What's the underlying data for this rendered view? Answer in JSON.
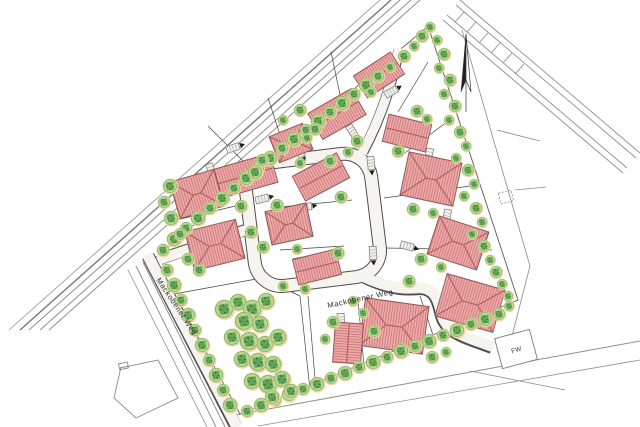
{
  "map": {
    "street_labels": [
      {
        "id": "street-left",
        "text": "Mackobener Weg"
      },
      {
        "id": "street-center",
        "text": "Mackobener Weg"
      }
    ],
    "markers": {
      "fw_label": "FW",
      "north_arrow_icon": "north-arrow"
    },
    "colors": {
      "roof_fill": "#ecaaa9",
      "roof_hatch": "#c76d6f",
      "roof_edge": "#8a5250",
      "roof_ridge": "#a95a5a",
      "tree_light": "#b5d88a",
      "tree_mid": "#5da054",
      "tree_dark": "#2e6e38",
      "tree_halo": "#f0d2a0",
      "tree_edge": "#6aa85e",
      "road_fill": "#f6f4ee",
      "road_edge": "#4f4f4f",
      "outer_line": "#8f8f8f",
      "plot_line": "#454545",
      "boundary": "#5a5a5a",
      "label": "#2b2b2b"
    },
    "features": {
      "houses": [
        [
          379,
          75,
          44,
          26,
          -33,
          "gable"
        ],
        [
          337,
          114,
          50,
          30,
          -30,
          "gable"
        ],
        [
          291,
          143,
          36,
          28,
          -22,
          "hip"
        ],
        [
          245,
          176,
          60,
          30,
          -16,
          "gable"
        ],
        [
          197,
          194,
          46,
          38,
          -16,
          "hip"
        ],
        [
          215,
          245,
          52,
          40,
          -14,
          "hip"
        ],
        [
          407,
          133,
          44,
          28,
          14,
          "gable"
        ],
        [
          431,
          179,
          54,
          44,
          12,
          "hip"
        ],
        [
          458,
          243,
          52,
          40,
          18,
          "hip"
        ],
        [
          470,
          303,
          60,
          44,
          16,
          "hip"
        ],
        [
          394,
          326,
          64,
          48,
          8,
          "hip"
        ],
        [
          348,
          343,
          40,
          28,
          94,
          "gable"
        ],
        [
          321,
          177,
          50,
          28,
          -28,
          "gable"
        ],
        [
          289,
          224,
          42,
          34,
          -12,
          "hip"
        ],
        [
          317,
          267,
          44,
          26,
          -14,
          "gable"
        ]
      ],
      "garages": [
        [
          211,
          170,
          72
        ],
        [
          262,
          199,
          -14
        ],
        [
          299,
          151,
          58
        ],
        [
          352,
          131,
          58
        ],
        [
          391,
          92,
          -30
        ],
        [
          371,
          163,
          84
        ],
        [
          305,
          207,
          -8
        ],
        [
          300,
          261,
          -10
        ],
        [
          373,
          253,
          86
        ],
        [
          407,
          246,
          16
        ],
        [
          388,
          306,
          12
        ],
        [
          341,
          320,
          86
        ],
        [
          429,
          155,
          100
        ],
        [
          447,
          216,
          100
        ],
        [
          233,
          148,
          -18
        ]
      ],
      "plot_divisions": [
        [
          268,
          98,
          287,
          156
        ],
        [
          331,
          52,
          345,
          118
        ],
        [
          428,
          62,
          398,
          112
        ],
        [
          447,
          122,
          398,
          158
        ],
        [
          470,
          186,
          384,
          198
        ],
        [
          492,
          250,
          386,
          248
        ],
        [
          364,
          366,
          358,
          300
        ],
        [
          316,
          390,
          308,
          296
        ],
        [
          208,
          126,
          250,
          168
        ],
        [
          176,
          220,
          244,
          204
        ],
        [
          174,
          294,
          262,
          278
        ],
        [
          262,
          278,
          300,
          296
        ],
        [
          300,
          296,
          310,
          390
        ],
        [
          270,
          208,
          352,
          200
        ],
        [
          280,
          250,
          344,
          246
        ],
        [
          420,
          296,
          436,
          344
        ]
      ],
      "trees": [
        [
          163,
          250,
          6
        ],
        [
          174,
          239,
          7
        ],
        [
          186,
          228,
          6
        ],
        [
          198,
          218,
          7
        ],
        [
          210,
          208,
          6
        ],
        [
          222,
          198,
          7
        ],
        [
          234,
          188,
          6
        ],
        [
          246,
          178,
          7
        ],
        [
          258,
          168,
          6
        ],
        [
          270,
          158,
          7
        ],
        [
          282,
          148,
          6
        ],
        [
          294,
          139,
          7
        ],
        [
          306,
          130,
          6
        ],
        [
          318,
          121,
          7
        ],
        [
          330,
          112,
          6
        ],
        [
          342,
          103,
          7
        ],
        [
          354,
          94,
          6
        ],
        [
          366,
          85,
          7
        ],
        [
          378,
          76,
          6
        ],
        [
          390,
          67,
          5
        ],
        [
          404,
          56,
          6
        ],
        [
          414,
          46,
          5
        ],
        [
          422,
          36,
          6
        ],
        [
          430,
          27,
          5
        ],
        [
          437,
          40,
          5
        ],
        [
          444,
          54,
          6
        ],
        [
          439,
          68,
          5
        ],
        [
          450,
          80,
          6
        ],
        [
          444,
          94,
          5
        ],
        [
          455,
          106,
          6
        ],
        [
          449,
          120,
          5
        ],
        [
          460,
          132,
          6
        ],
        [
          466,
          146,
          5
        ],
        [
          456,
          158,
          5
        ],
        [
          468,
          170,
          6
        ],
        [
          474,
          184,
          5
        ],
        [
          464,
          196,
          5
        ],
        [
          476,
          208,
          6
        ],
        [
          482,
          222,
          5
        ],
        [
          472,
          234,
          5
        ],
        [
          484,
          246,
          6
        ],
        [
          490,
          260,
          5
        ],
        [
          496,
          272,
          6
        ],
        [
          502,
          284,
          5
        ],
        [
          508,
          296,
          5
        ],
        [
          499,
          314,
          6
        ],
        [
          485,
          319,
          7
        ],
        [
          471,
          324,
          6
        ],
        [
          457,
          330,
          7
        ],
        [
          443,
          335,
          6
        ],
        [
          429,
          341,
          7
        ],
        [
          415,
          346,
          6
        ],
        [
          401,
          351,
          7
        ],
        [
          387,
          357,
          6
        ],
        [
          373,
          362,
          7
        ],
        [
          359,
          367,
          6
        ],
        [
          345,
          373,
          7
        ],
        [
          331,
          378,
          6
        ],
        [
          317,
          384,
          7
        ],
        [
          303,
          389,
          6
        ],
        [
          289,
          394,
          7
        ],
        [
          275,
          400,
          6
        ],
        [
          261,
          405,
          7
        ],
        [
          247,
          411,
          6
        ],
        [
          167,
          270,
          6
        ],
        [
          174,
          285,
          7
        ],
        [
          181,
          300,
          6
        ],
        [
          188,
          315,
          7
        ],
        [
          195,
          330,
          6
        ],
        [
          202,
          345,
          7
        ],
        [
          209,
          360,
          6
        ],
        [
          216,
          375,
          7
        ],
        [
          223,
          390,
          6
        ],
        [
          230,
          405,
          7
        ],
        [
          224,
          309,
          9
        ],
        [
          238,
          302,
          8
        ],
        [
          252,
          309,
          9
        ],
        [
          266,
          301,
          8
        ],
        [
          244,
          321,
          9
        ],
        [
          260,
          324,
          8
        ],
        [
          232,
          337,
          8
        ],
        [
          249,
          341,
          9
        ],
        [
          265,
          344,
          8
        ],
        [
          278,
          337,
          8
        ],
        [
          242,
          359,
          8
        ],
        [
          258,
          362,
          9
        ],
        [
          273,
          364,
          8
        ],
        [
          252,
          381,
          8
        ],
        [
          268,
          384,
          9
        ],
        [
          282,
          379,
          8
        ],
        [
          291,
          391,
          7
        ],
        [
          272,
          397,
          7
        ],
        [
          170,
          186,
          7
        ],
        [
          164,
          202,
          6
        ],
        [
          171,
          218,
          7
        ],
        [
          180,
          234,
          6
        ],
        [
          241,
          206,
          6
        ],
        [
          251,
          232,
          6
        ],
        [
          188,
          259,
          6
        ],
        [
          199,
          270,
          6
        ],
        [
          262,
          160,
          6
        ],
        [
          255,
          172,
          7
        ],
        [
          315,
          129,
          6
        ],
        [
          307,
          138,
          5
        ],
        [
          357,
          141,
          6
        ],
        [
          348,
          152,
          5
        ],
        [
          371,
          92,
          5
        ],
        [
          300,
          110,
          6
        ],
        [
          283,
          120,
          5
        ],
        [
          330,
          161,
          6
        ],
        [
          300,
          163,
          5
        ],
        [
          341,
          197,
          6
        ],
        [
          277,
          205,
          6
        ],
        [
          263,
          247,
          6
        ],
        [
          297,
          249,
          5
        ],
        [
          338,
          253,
          6
        ],
        [
          305,
          289,
          5
        ],
        [
          283,
          286,
          5
        ],
        [
          417,
          111,
          6
        ],
        [
          398,
          151,
          6
        ],
        [
          413,
          209,
          6
        ],
        [
          433,
          213,
          5
        ],
        [
          421,
          259,
          6
        ],
        [
          441,
          267,
          5
        ],
        [
          409,
          281,
          6
        ],
        [
          432,
          357,
          6
        ],
        [
          446,
          352,
          5
        ],
        [
          374,
          331,
          6
        ],
        [
          363,
          313,
          5
        ],
        [
          333,
          322,
          6
        ],
        [
          325,
          339,
          5
        ],
        [
          353,
          301,
          5
        ],
        [
          509,
          306,
          5
        ],
        [
          427,
          119,
          5
        ]
      ]
    }
  }
}
